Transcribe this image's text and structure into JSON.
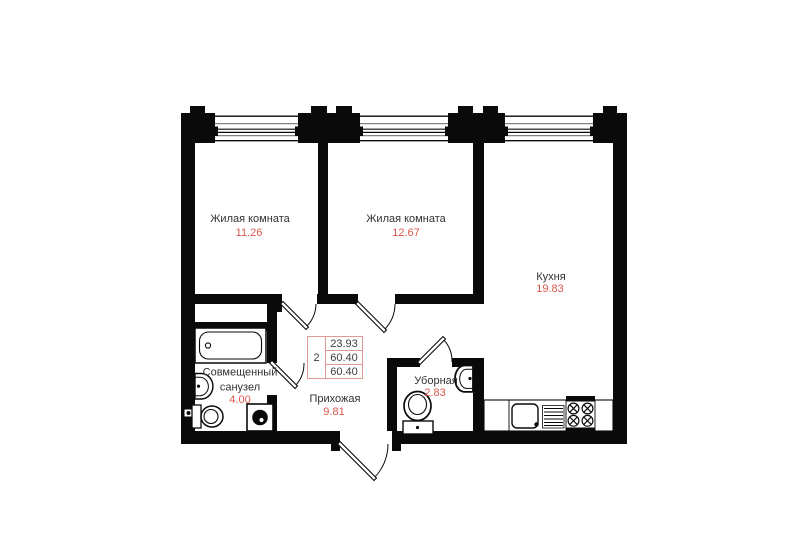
{
  "plan_type": "apartment-floor-plan",
  "rooms": [
    {
      "id": "living-room-1",
      "name": "Жилая комната",
      "area": "11.26"
    },
    {
      "id": "living-room-2",
      "name": "Жилая комната",
      "area": "12.67"
    },
    {
      "id": "kitchen",
      "name": "Кухня",
      "area": "19.83"
    },
    {
      "id": "bathroom",
      "name": "Совмещенный санузел",
      "area": "4.00"
    },
    {
      "id": "hallway",
      "name": "Прихожая",
      "area": "9.81"
    },
    {
      "id": "wc",
      "name": "Уборная",
      "area": "2.83"
    }
  ],
  "info_table": {
    "rooms_count": "2",
    "living_area": "23.93",
    "area": "60.40",
    "total_area": "60.40"
  },
  "colors": {
    "wall": "#0a0a0a",
    "area_number": "#dc574e",
    "label_text": "#323232",
    "table_border": "#e09a93",
    "background": "#ffffff"
  }
}
